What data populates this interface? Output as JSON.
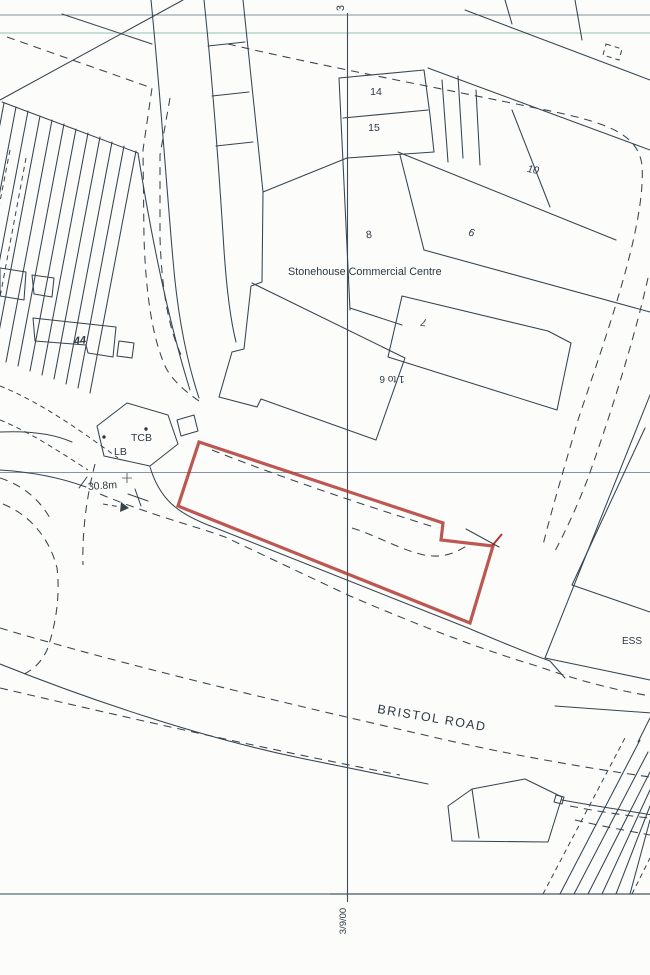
{
  "document": {
    "type": "scanned site location plan",
    "background_color": "#fcfcfa",
    "ink_color": "#35444f",
    "site_boundary_color": "#b03a33",
    "gridline_color": "#3c4d58",
    "tint_line_colors": [
      "#7e949c",
      "#b7d4c9",
      "#8496a2",
      "#46565f"
    ]
  },
  "grid": {
    "top_label": "3",
    "bottom_label": "3/9/00"
  },
  "labels": {
    "centre_name": "Stonehouse Commercial Centre",
    "road_name": "BRISTOL ROAD",
    "ess": "ESS",
    "tcb": "TCB",
    "lb": "LB",
    "spot_height": "30.8m",
    "n14": "14",
    "n15": "15",
    "n10": "10",
    "n8": "8",
    "n9": "9",
    "n7": "7",
    "n44": "44",
    "n1to6": "1 to 6",
    "grid_top": "3",
    "grid_bottom": "3/9/00"
  }
}
